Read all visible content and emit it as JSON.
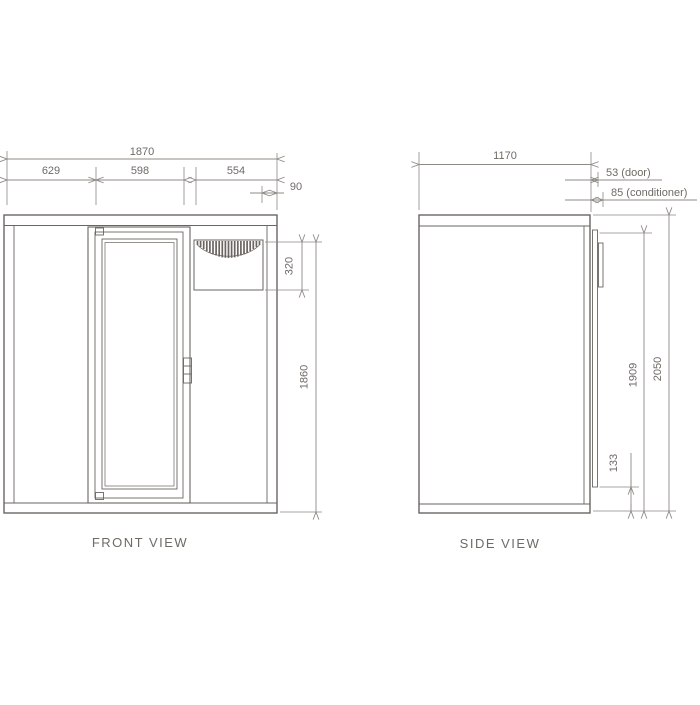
{
  "colors": {
    "object_line": "#6a6560",
    "dimension_line": "#8f8984",
    "text": "#6f6a64",
    "background": "#ffffff"
  },
  "front_view": {
    "title": "FRONT VIEW",
    "dimensions": {
      "overall_width": "1870",
      "edge_to_door": "629",
      "door_width": "598",
      "vent_section": "554",
      "conditioner_edge_gap": "90",
      "conditioner_height": "320",
      "body_height": "1860"
    }
  },
  "side_view": {
    "title": "SIDE VIEW",
    "dimensions": {
      "overall_depth": "1170",
      "door_protrusion": "53 (door)",
      "conditioner_protrusion": "85 (conditioner)",
      "door_height_total": "1909",
      "overall_height": "2050",
      "floor_gap": "133"
    }
  }
}
